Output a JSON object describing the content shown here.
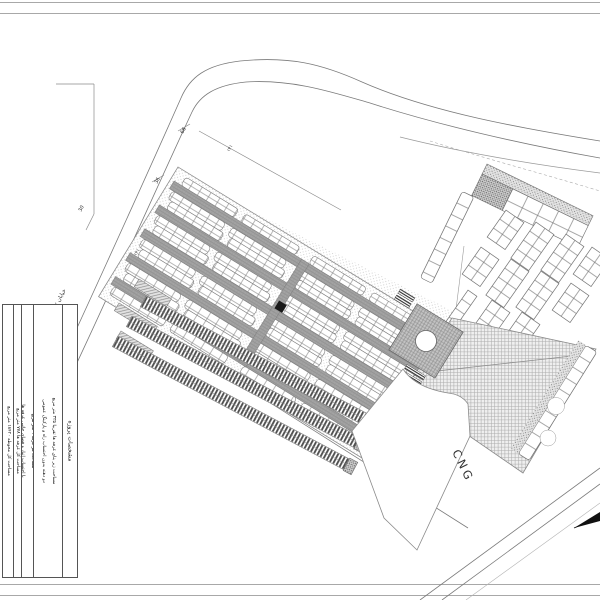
{
  "title_block": {
    "header": "مشخصات پروژه",
    "rows": [
      {
        "line1": "مساحت زیر بنای غرفه ها تقریبا ۳۳۵ متر مربع",
        "line2": "دو دهنه بدون احتساب راه و پارکینگ عمومی"
      },
      {
        "line1": "مساحت هر غرفه ۹ متر مربع",
        "line2": "با احتساب انبار و فضای جانبی غرفه ها"
      },
      {
        "line1": "مساحت کل غرفه ها ۷۷۸ متر مربع"
      },
      {
        "line1": "مساحت کل محوطه ۱۸۴۲۰ متر مربع"
      }
    ]
  },
  "labels": {
    "cng": "CNG",
    "street": "خیابان ۲",
    "dim_66": "66",
    "dim_36": "36",
    "dim_30": "30",
    "edge_note_top": "۱۴۱",
    "edge_note_left": "۱۴۱"
  }
}
